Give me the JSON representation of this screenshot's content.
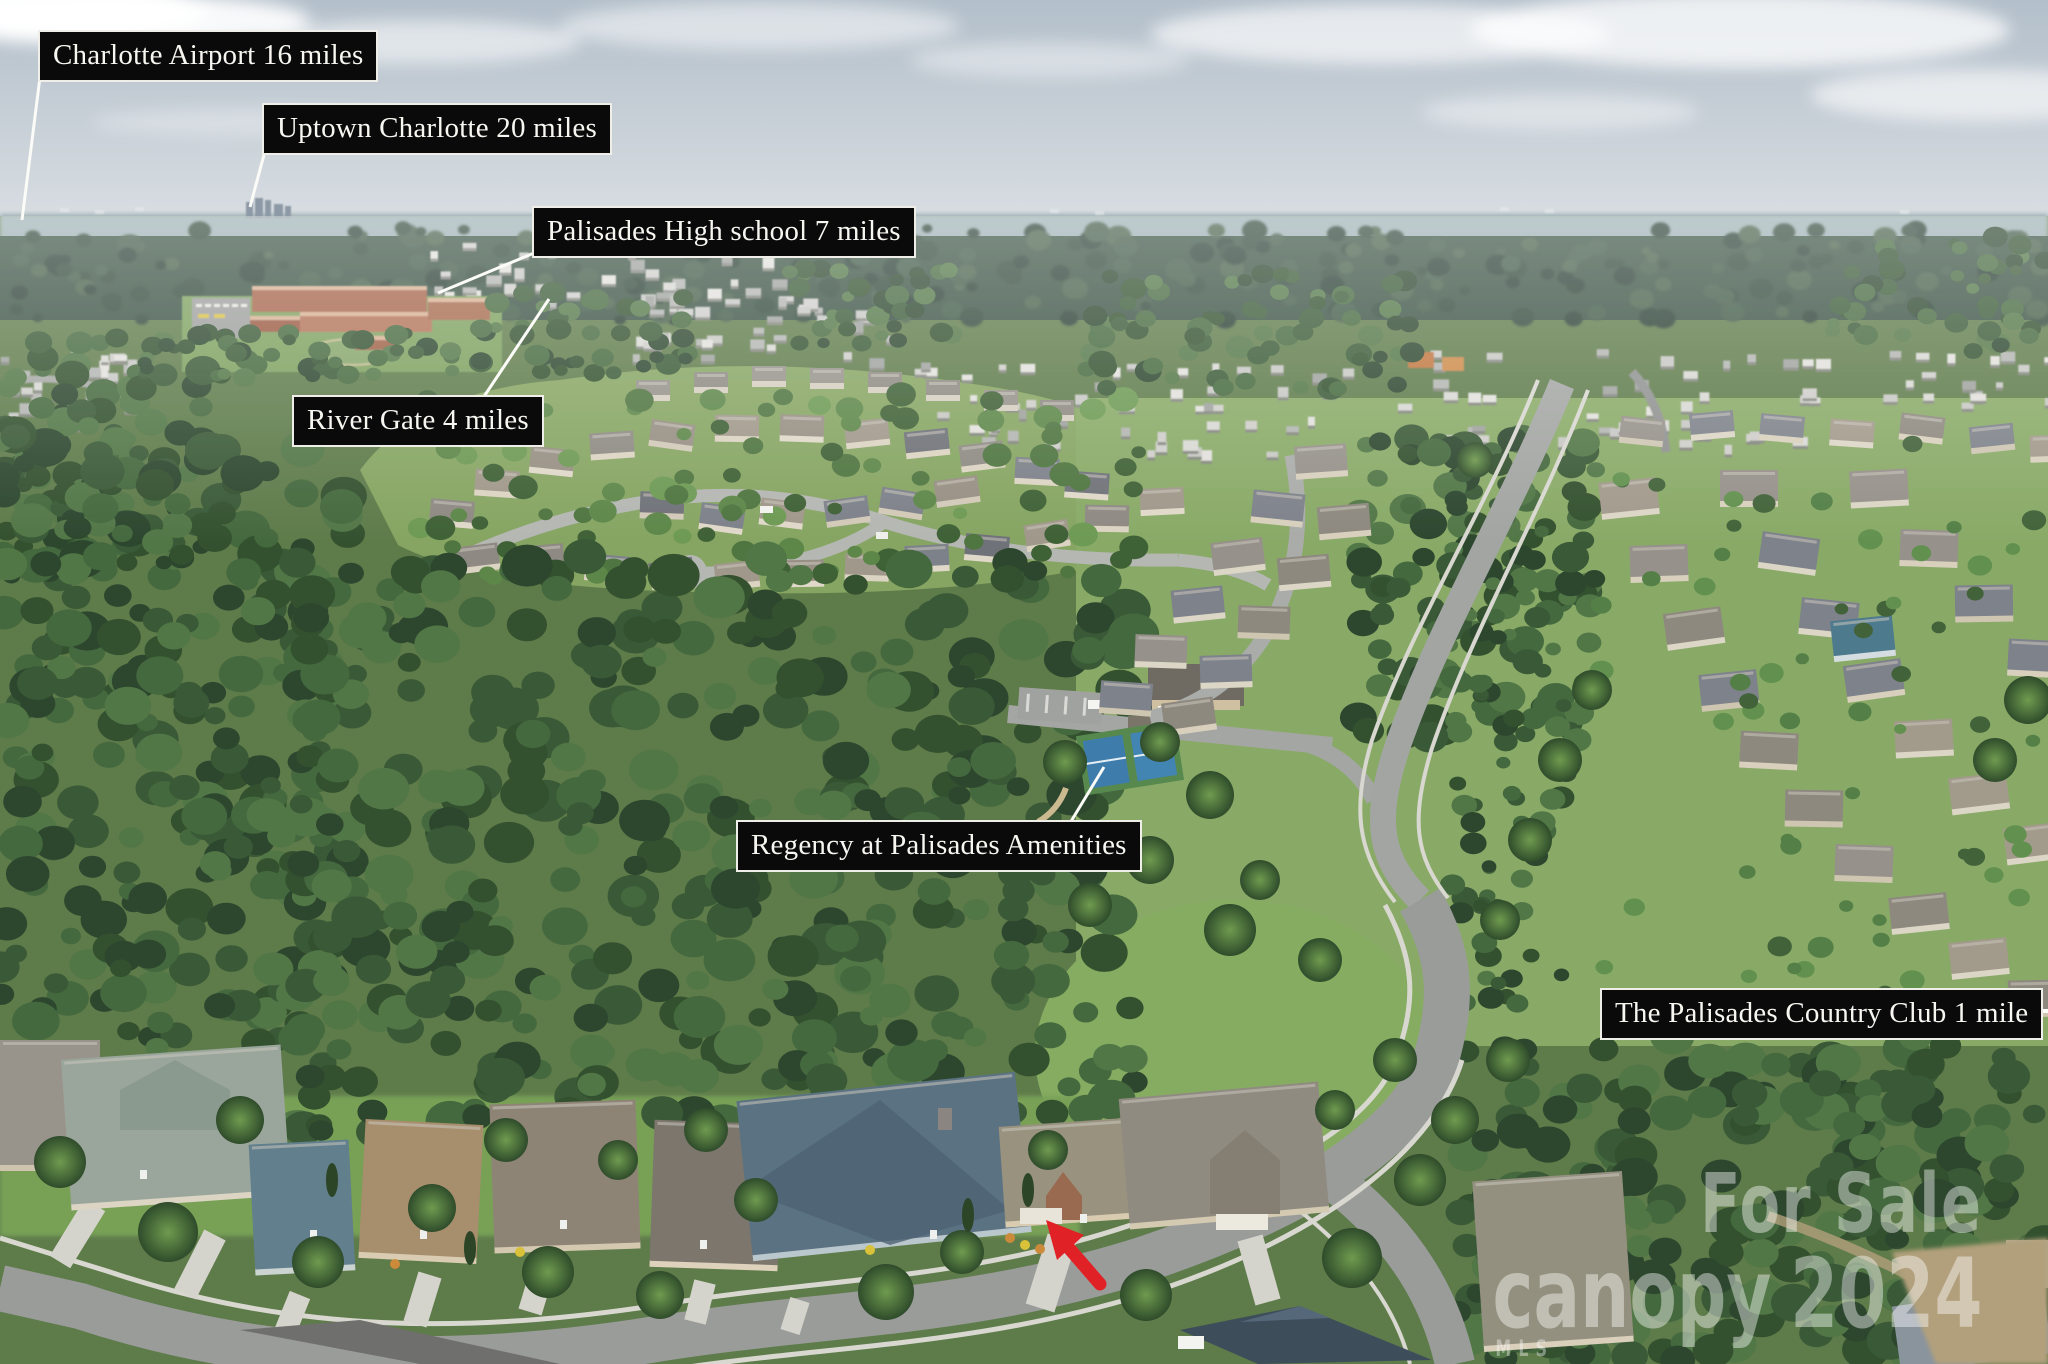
{
  "labels": [
    {
      "text": "Charlotte Airport 16 miles"
    },
    {
      "text": "Uptown Charlotte 20 miles"
    },
    {
      "text": "Palisades High school 7 miles"
    },
    {
      "text": "River Gate 4 miles"
    },
    {
      "text": "Regency at Palisades Amenities"
    },
    {
      "text": "The Palisades Country Club 1 mile"
    }
  ],
  "watermark": {
    "sale": "For Sale",
    "brand": "canopy",
    "mls": "MLS",
    "year": "2024"
  },
  "colors": {
    "label_bg": "#0a0a0a",
    "label_border": "#efeee8",
    "label_text": "#f7f6f1",
    "leader_line": "#fbfbf8",
    "arrow_red": "#e02125",
    "watermark": "rgba(255,255,255,0.42)"
  }
}
